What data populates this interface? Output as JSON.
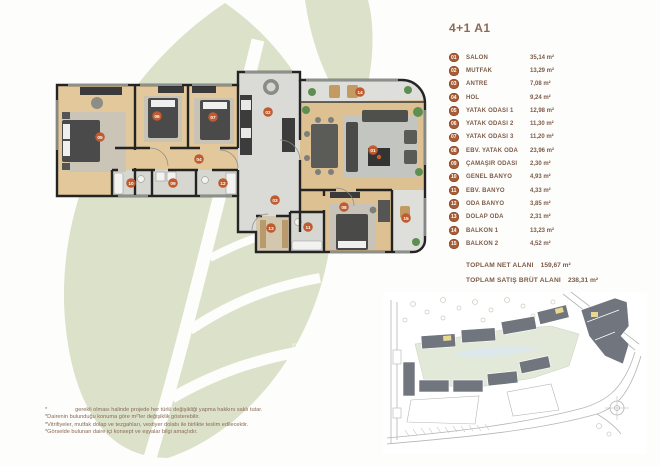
{
  "page": {
    "title": "4+1 A1"
  },
  "legend": {
    "items": [
      {
        "id": "01",
        "label": "SALON",
        "area": "35,14 m²"
      },
      {
        "id": "02",
        "label": "MUTFAK",
        "area": "13,29 m²"
      },
      {
        "id": "03",
        "label": "ANTRE",
        "area": "7,08 m²"
      },
      {
        "id": "04",
        "label": "HOL",
        "area": "9,24 m²"
      },
      {
        "id": "05",
        "label": "YATAK ODASI 1",
        "area": "12,98 m²"
      },
      {
        "id": "06",
        "label": "YATAK ODASI 2",
        "area": "11,30 m²"
      },
      {
        "id": "07",
        "label": "YATAK ODASI 3",
        "area": "11,20 m²"
      },
      {
        "id": "08",
        "label": "EBV. YATAK ODA",
        "area": "23,96 m²"
      },
      {
        "id": "09",
        "label": "ÇAMAŞIR ODASI",
        "area": "2,30 m²"
      },
      {
        "id": "10",
        "label": "GENEL BANYO",
        "area": "4,93 m²"
      },
      {
        "id": "11",
        "label": "EBV. BANYO",
        "area": "4,33 m²"
      },
      {
        "id": "12",
        "label": "ODA BANYO",
        "area": "3,85 m²"
      },
      {
        "id": "13",
        "label": "DOLAP ODA",
        "area": "2,31 m²"
      },
      {
        "id": "14",
        "label": "BALKON 1",
        "area": "13,23 m²"
      },
      {
        "id": "15",
        "label": "BALKON 2",
        "area": "4,52 m²"
      }
    ]
  },
  "totals": {
    "net_label": "TOPLAM NET ALANI",
    "net_value": "159,67 m²",
    "gross_label": "TOPLAM SATIŞ BRÜT ALANI",
    "gross_value": "238,31 m²"
  },
  "footnotes": {
    "line1": "*                  gerekli olması halinde projede her türlü değişikliği yapma hakkını saklı tutar.",
    "line2": "*Dairenin bulunduğu konuma göre m²'ler değişiklik gösterebilir.",
    "line3": "*Vitrifiyeler, mutfak dolap ve tezgahları, vestiyer dolabı ile birlikte teslim edilecektir.",
    "line4": "*Görselde bulunan daire içi konsept ve eşyalar bilgi amaçlıdır."
  },
  "colors": {
    "badge_copper": "#a85d36",
    "marker_copper": "#bf5b2e",
    "text_brown": "#7d5b49",
    "leaf_watermark": "#dce1c9",
    "wall": "#242424",
    "wood_floor": "#e0c597",
    "tile_gray": "#dadad6",
    "site_building_gray": "#70757e",
    "site_highlight_yellow": "#e8d88f",
    "site_green": "#e3e9d8"
  }
}
